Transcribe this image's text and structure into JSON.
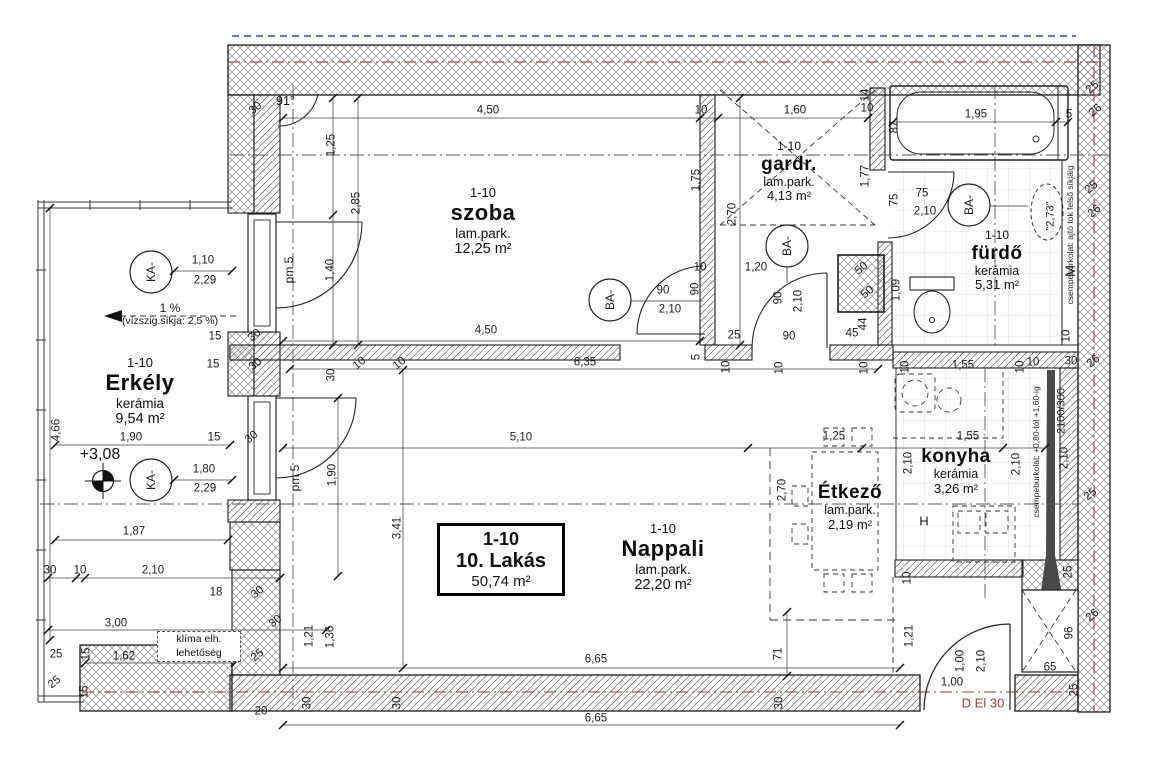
{
  "drawing": {
    "title_box": {
      "code": "1-10",
      "name": "10. Lakás",
      "area": "50,74 m²"
    },
    "rooms": {
      "szoba": {
        "code": "1-10",
        "name": "szoba",
        "finish": "lam.park.",
        "area": "12,25 m²"
      },
      "gardrob": {
        "code": "1-10",
        "name": "gardr.",
        "finish": "lam.park.",
        "area": "4,13 m²"
      },
      "furdo": {
        "code": "1-10",
        "name": "fürdő",
        "finish": "kerámia",
        "area": "5,31 m²"
      },
      "erkely": {
        "code": "1-10",
        "name": "Erkély",
        "finish": "kerámia",
        "area": "9,54 m²"
      },
      "nappali": {
        "code": "1-10",
        "name": "Nappali",
        "finish": "lam.park.",
        "area": "22,20 m²"
      },
      "konyha": {
        "name": "konyha",
        "finish": "kerámia",
        "area": "3,26 m²"
      },
      "etkezo": {
        "name": "Étkező",
        "finish": "lam.park.",
        "area": "2,19 m²"
      }
    },
    "notes": {
      "angle": "91°",
      "level": "+3,08",
      "slope": "1 %",
      "slope_detail": "(vízszig.síkja: 2,5 %)",
      "klima_line1": "klíma elh.",
      "klima_line2": "lehetőség"
    },
    "colors": {
      "door_code_red": "#9e3c3c",
      "axis_red": "#993333",
      "top_dash_blue": "#3340b0"
    },
    "labels": [
      {
        "t": "KA-",
        "x": 151,
        "y": 272,
        "r": -90,
        "n": "ka-circle-label",
        "fs": 12
      },
      {
        "t": "KA-",
        "x": 151,
        "y": 480,
        "r": -90,
        "n": "ka-circle-label",
        "fs": 12
      },
      {
        "t": "BA-",
        "x": 610,
        "y": 300,
        "r": -90,
        "n": "ba-circle-label",
        "fs": 12
      },
      {
        "t": "BA-",
        "x": 787,
        "y": 246,
        "r": -90,
        "n": "ba-circle-label",
        "fs": 12
      },
      {
        "t": "BA-",
        "x": 969,
        "y": 205,
        "r": -90,
        "n": "ba-circle-label",
        "fs": 12
      },
      {
        "t": "pm 5",
        "x": 289,
        "y": 270,
        "r": -90,
        "n": "pm5-label",
        "fs": 12
      },
      {
        "t": "pm 5",
        "x": 295,
        "y": 478,
        "r": -90,
        "n": "pm5-label",
        "fs": 12
      },
      {
        "t": "M",
        "x": 1070,
        "y": 271,
        "r": -90,
        "n": "washing-machine-label",
        "fs": 14
      },
      {
        "t": "H",
        "x": 924,
        "y": 521,
        "n": "fridge-label",
        "fs": 13
      },
      {
        "t": "\"2,73\"",
        "x": 1051,
        "y": 216,
        "r": -90,
        "n": "ceiling-height-label",
        "fs": 11
      },
      {
        "t": "2100/300",
        "x": 1062,
        "y": 411,
        "r": -90,
        "n": "shaft-size-label",
        "fs": 11
      },
      {
        "t": "csempeburkolat: ajtó tok felső síkjáig",
        "x": 1070,
        "y": 235,
        "r": -90,
        "n": "tile-note-bathroom",
        "fs": 8.5
      },
      {
        "t": "csempeburkolat: +0,80-tól +1,60-ig",
        "x": 1036,
        "y": 452,
        "r": -90,
        "n": "tile-note-kitchen",
        "fs": 8.5
      },
      {
        "t": "D El 30",
        "x": 983,
        "y": 703,
        "n": "entry-door-code",
        "fs": 13,
        "c": "#9e3c3c"
      }
    ],
    "dimensions": [
      {
        "t": "30",
        "x": 256,
        "y": 109,
        "r": -38
      },
      {
        "t": "4,50",
        "x": 488,
        "y": 111
      },
      {
        "t": "1,25",
        "x": 332,
        "y": 145,
        "r": -90
      },
      {
        "t": "2,85",
        "x": 357,
        "y": 203,
        "r": -90
      },
      {
        "t": "1,40",
        "x": 331,
        "y": 270,
        "r": -90
      },
      {
        "t": "10",
        "x": 701,
        "y": 111
      },
      {
        "t": "1,60",
        "x": 795,
        "y": 111
      },
      {
        "t": "10",
        "x": 867,
        "y": 109
      },
      {
        "t": "14",
        "x": 866,
        "y": 95,
        "r": -90
      },
      {
        "t": "1,95",
        "x": 976,
        "y": 115
      },
      {
        "t": "5",
        "x": 1069,
        "y": 115
      },
      {
        "t": "87",
        "x": 895,
        "y": 127,
        "r": -90
      },
      {
        "t": "1,75",
        "x": 697,
        "y": 180,
        "r": -90
      },
      {
        "t": "2,70",
        "x": 733,
        "y": 214,
        "r": -90
      },
      {
        "t": "1,77",
        "x": 866,
        "y": 176,
        "r": -90
      },
      {
        "t": "75",
        "x": 895,
        "y": 200,
        "r": -90
      },
      {
        "t": "75",
        "x": 922,
        "y": 194
      },
      {
        "t": "2,10",
        "x": 925,
        "y": 212
      },
      {
        "t": "25",
        "x": 1093,
        "y": 88,
        "r": -40
      },
      {
        "t": "26",
        "x": 1096,
        "y": 111,
        "r": -40
      },
      {
        "t": "25",
        "x": 1092,
        "y": 188,
        "r": -40
      },
      {
        "t": "26",
        "x": 1095,
        "y": 212,
        "r": -40
      },
      {
        "t": "26",
        "x": 1094,
        "y": 362,
        "r": -40
      },
      {
        "t": "30",
        "x": 1071,
        "y": 362
      },
      {
        "t": "10",
        "x": 1067,
        "y": 336,
        "r": -90
      },
      {
        "t": "90",
        "x": 663,
        "y": 291
      },
      {
        "t": "2,10",
        "x": 670,
        "y": 310
      },
      {
        "t": "10",
        "x": 700,
        "y": 268
      },
      {
        "t": "1,20",
        "x": 756,
        "y": 268
      },
      {
        "t": "90",
        "x": 696,
        "y": 289,
        "r": -90
      },
      {
        "t": "90",
        "x": 779,
        "y": 298,
        "r": -90
      },
      {
        "t": "2,10",
        "x": 799,
        "y": 301,
        "r": -90
      },
      {
        "t": "25",
        "x": 734,
        "y": 336
      },
      {
        "t": "90",
        "x": 789,
        "y": 337
      },
      {
        "t": "45",
        "x": 852,
        "y": 334
      },
      {
        "t": "44",
        "x": 864,
        "y": 324,
        "r": -90
      },
      {
        "t": "50",
        "x": 862,
        "y": 269,
        "r": -40
      },
      {
        "t": "50",
        "x": 868,
        "y": 293,
        "r": -40
      },
      {
        "t": "1,09",
        "x": 897,
        "y": 290,
        "r": -90
      },
      {
        "t": "5",
        "x": 697,
        "y": 357,
        "r": -90
      },
      {
        "t": "10",
        "x": 727,
        "y": 367,
        "r": -90
      },
      {
        "t": "10",
        "x": 780,
        "y": 368,
        "r": -90
      },
      {
        "t": "10",
        "x": 865,
        "y": 368,
        "r": -90
      },
      {
        "t": "4,50",
        "x": 486,
        "y": 331
      },
      {
        "t": "6,35",
        "x": 585,
        "y": 363
      },
      {
        "t": "30",
        "x": 332,
        "y": 375,
        "r": -90
      },
      {
        "t": "10",
        "x": 360,
        "y": 364,
        "r": -40
      },
      {
        "t": "10",
        "x": 400,
        "y": 364,
        "r": -40
      },
      {
        "t": "5,10",
        "x": 521,
        "y": 438
      },
      {
        "t": "1,25",
        "x": 834,
        "y": 437
      },
      {
        "t": "1,55",
        "x": 968,
        "y": 437
      },
      {
        "t": "2,70",
        "x": 783,
        "y": 490,
        "r": -90
      },
      {
        "t": "3,41",
        "x": 398,
        "y": 528,
        "r": -90
      },
      {
        "t": "1,90",
        "x": 333,
        "y": 475,
        "r": -90
      },
      {
        "t": "1,55",
        "x": 963,
        "y": 366
      },
      {
        "t": "10",
        "x": 906,
        "y": 367,
        "r": -90
      },
      {
        "t": "10",
        "x": 1021,
        "y": 367,
        "r": -90
      },
      {
        "t": "10",
        "x": 1033,
        "y": 363
      },
      {
        "t": "2,10",
        "x": 909,
        "y": 463,
        "r": -90
      },
      {
        "t": "2,10",
        "x": 1017,
        "y": 464,
        "r": -90
      },
      {
        "t": "2,10",
        "x": 1065,
        "y": 458,
        "r": -90
      },
      {
        "t": "25",
        "x": 1091,
        "y": 495,
        "r": -40
      },
      {
        "t": "25",
        "x": 1069,
        "y": 572,
        "r": -90
      },
      {
        "t": "26",
        "x": 1093,
        "y": 616,
        "r": -40
      },
      {
        "t": "96",
        "x": 1070,
        "y": 633,
        "r": -90
      },
      {
        "t": "65",
        "x": 1050,
        "y": 668
      },
      {
        "t": "25",
        "x": 1075,
        "y": 690,
        "r": -90
      },
      {
        "t": "10",
        "x": 908,
        "y": 578,
        "r": -90
      },
      {
        "t": "1,21",
        "x": 910,
        "y": 636,
        "r": -90
      },
      {
        "t": "1,00",
        "x": 961,
        "y": 661,
        "r": -90
      },
      {
        "t": "2,10",
        "x": 982,
        "y": 661,
        "r": -90
      },
      {
        "t": "1,00",
        "x": 952,
        "y": 683
      },
      {
        "t": "6,65",
        "x": 596,
        "y": 660
      },
      {
        "t": "71",
        "x": 779,
        "y": 654,
        "r": -90
      },
      {
        "t": "30",
        "x": 780,
        "y": 703,
        "r": -90
      },
      {
        "t": "6,65",
        "x": 596,
        "y": 719
      },
      {
        "t": "30",
        "x": 308,
        "y": 703,
        "r": -90
      },
      {
        "t": "30",
        "x": 398,
        "y": 703,
        "r": -90
      },
      {
        "t": "1,21",
        "x": 310,
        "y": 636,
        "r": -90
      },
      {
        "t": "1,36",
        "x": 331,
        "y": 637,
        "r": -90
      },
      {
        "t": "1,10",
        "x": 203,
        "y": 261
      },
      {
        "t": "2,29",
        "x": 205,
        "y": 281
      },
      {
        "t": "1,80",
        "x": 204,
        "y": 470
      },
      {
        "t": "2,29",
        "x": 205,
        "y": 489
      },
      {
        "t": "15",
        "x": 215,
        "y": 337
      },
      {
        "t": "30",
        "x": 255,
        "y": 336,
        "r": -38
      },
      {
        "t": "15",
        "x": 213,
        "y": 365
      },
      {
        "t": "30",
        "x": 256,
        "y": 365,
        "r": -38
      },
      {
        "t": "15",
        "x": 214,
        "y": 438
      },
      {
        "t": "30",
        "x": 252,
        "y": 438,
        "r": -38
      },
      {
        "t": "4,66",
        "x": 57,
        "y": 430,
        "r": -90
      },
      {
        "t": "1,90",
        "x": 131,
        "y": 438
      },
      {
        "t": "1,87",
        "x": 134,
        "y": 532
      },
      {
        "t": "30",
        "x": 50,
        "y": 571
      },
      {
        "t": "10",
        "x": 80,
        "y": 571
      },
      {
        "t": "2,10",
        "x": 153,
        "y": 571
      },
      {
        "t": "18",
        "x": 216,
        "y": 593
      },
      {
        "t": "30",
        "x": 258,
        "y": 593,
        "r": -38
      },
      {
        "t": "3,00",
        "x": 116,
        "y": 624
      },
      {
        "t": "30",
        "x": 276,
        "y": 622,
        "r": -38
      },
      {
        "t": "25",
        "x": 56,
        "y": 655
      },
      {
        "t": "15",
        "x": 87,
        "y": 654,
        "r": -90
      },
      {
        "t": "1,62",
        "x": 124,
        "y": 657
      },
      {
        "t": "23",
        "x": 234,
        "y": 655,
        "r": -38
      },
      {
        "t": "25",
        "x": 258,
        "y": 656,
        "r": -38
      },
      {
        "t": "25",
        "x": 55,
        "y": 683,
        "r": -38
      },
      {
        "t": "15",
        "x": 85,
        "y": 692,
        "r": -90
      },
      {
        "t": "20",
        "x": 261,
        "y": 712
      }
    ]
  }
}
